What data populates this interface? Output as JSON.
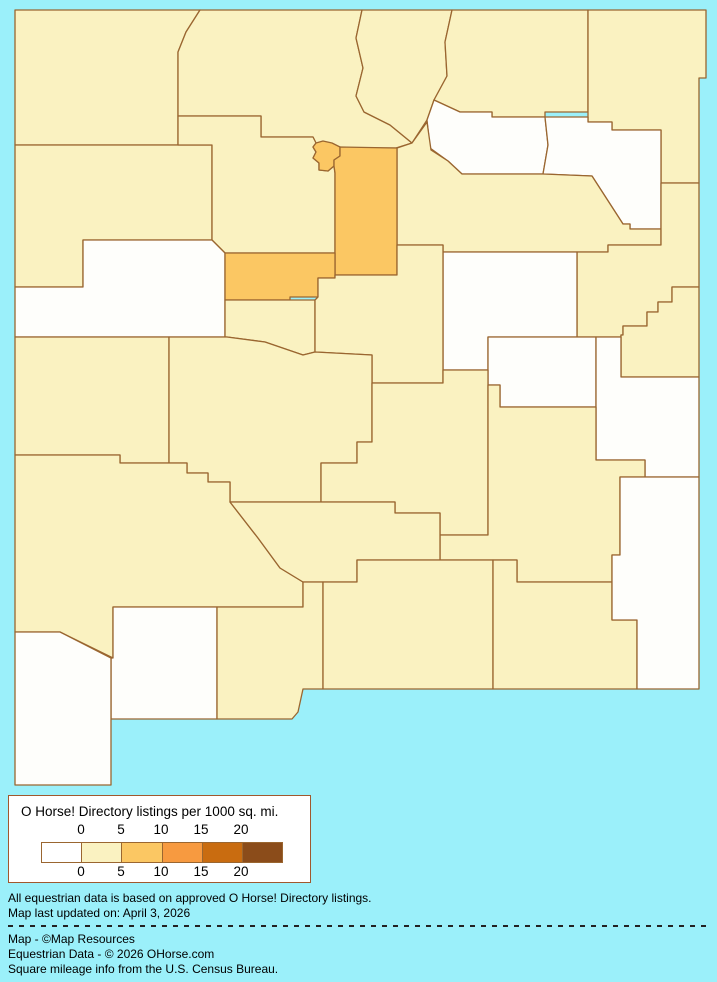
{
  "colors": {
    "background": "#9BF0FA",
    "county_border": "#9A6630",
    "bins": {
      "zero": "#FEFEFB",
      "low": "#FAF2C1",
      "mid": "#FBC763"
    }
  },
  "legend": {
    "title": "O Horse! Directory listings per 1000 sq. mi.",
    "ticks": [
      "0",
      "5",
      "10",
      "15",
      "20"
    ],
    "swatches": [
      "#FFFFFF",
      "#FAF2C1",
      "#FBC763",
      "#F79A40",
      "#C96C10",
      "#8B4C1A"
    ],
    "scale_note": "bins: 0, 0-5, 5-10, 10-15, 15-20, 20+"
  },
  "footer": {
    "line1": "All equestrian data is based on approved O Horse! Directory listings.",
    "line2": "Map last updated on: April 3, 2026",
    "line3": "Map - ©Map Resources",
    "line4": "Equestrian Data - © 2026 OHorse.com",
    "line5": "Square mileage info from the U.S. Census Bureau."
  },
  "map": {
    "region": "New Mexico counties choropleth",
    "counties": [
      {
        "id": "san-juan",
        "bin": "low",
        "d": "M15,10 L200,10 L186,32 L178,52 L178,145 L15,145 Z"
      },
      {
        "id": "rio-arriba",
        "bin": "low",
        "d": "M200,10 L362,10 L356,38 L363,68 L356,96 L364,112 L390,125 L412,143 L396,148 L342,148 L340,147 L316,143 L313,137 L261,137 L261,116 L178,116 L178,52 L186,32 Z"
      },
      {
        "id": "taos",
        "bin": "low",
        "d": "M362,10 L452,10 L445,42 L447,76 L434,100 L427,120 L412,143 L390,125 L364,112 L356,96 L363,68 L356,38 Z"
      },
      {
        "id": "colfax",
        "bin": "low",
        "d": "M452,10 L588,10 L588,112 L545,112 L545,117 L492,117 L492,112 L460,112 L434,100 L447,76 L445,42 Z"
      },
      {
        "id": "union",
        "bin": "low",
        "d": "M588,10 L706,10 L706,78 L699,78 L699,183 L661,183 L661,130 L612,130 L612,122 L588,122 Z"
      },
      {
        "id": "mora",
        "bin": "zero",
        "d": "M434,100 L460,112 L492,112 L492,117 L545,117 L548,145 L543,174 L462,174 L448,161 L430,148 L427,120 Z"
      },
      {
        "id": "harding",
        "bin": "zero",
        "d": "M545,117 L588,117 L588,122 L612,122 L612,130 L661,130 L661,229 L630,229 L630,224 L623,224 L592,176 L543,174 L548,145 Z"
      },
      {
        "id": "san-miguel",
        "bin": "low",
        "d": "M397,148 L412,143 L427,122 L431,150 L448,161 L462,174 L543,174 L592,176 L623,224 L630,224 L630,229 L661,229 L661,245 L608,245 L608,252 L443,252 L443,245 L397,245 Z"
      },
      {
        "id": "quay",
        "bin": "low",
        "d": "M661,183 L699,183 L699,287 L672,287 L672,302 L658,302 L658,312 L647,312 L647,326 L623,326 L623,335 L621,335 L621,337 L577,337 L577,252 L608,252 L608,245 L661,245 Z"
      },
      {
        "id": "curry",
        "bin": "low",
        "d": "M672,287 L699,287 L699,377 L621,377 L621,335 L623,335 L623,326 L647,326 L647,312 L658,312 L658,302 L672,302 Z"
      },
      {
        "id": "guadalupe",
        "bin": "zero",
        "d": "M443,252 L577,252 L577,337 L488,337 L488,370 L443,370 Z"
      },
      {
        "id": "de-baca",
        "bin": "zero",
        "d": "M488,337 L596,337 L596,407 L500,407 L500,385 L488,385 Z"
      },
      {
        "id": "roosevelt",
        "bin": "zero",
        "d": "M596,337 L621,337 L621,377 L699,377 L699,477 L645,477 L645,460 L596,460 Z"
      },
      {
        "id": "mckinley",
        "bin": "low",
        "d": "M15,145 L212,145 L212,240 L83,240 L83,287 L15,287 Z"
      },
      {
        "id": "sandoval",
        "bin": "low",
        "d": "M178,116 L261,116 L261,137 L313,137 L316,143 L313,147 L316,152 L313,158 L319,163 L319,170 L328,171 L334,166 L335,173 L335,253 L225,253 L212,240 L212,145 L178,145 Z"
      },
      {
        "id": "cibola",
        "bin": "zero",
        "d": "M83,240 L212,240 L225,253 L225,337 L15,337 L15,287 L83,287 Z"
      },
      {
        "id": "los-alamos",
        "bin": "mid",
        "d": "M313,147 L316,143 L323,141 L332,143 L340,147 L340,156 L334,160 L334,166 L328,171 L319,170 L319,163 L313,158 L316,152 Z"
      },
      {
        "id": "santa-fe",
        "bin": "mid",
        "d": "M340,147 L397,148 L397,275 L335,275 L335,173 L334,166 L334,160 L340,156 Z"
      },
      {
        "id": "bernalillo",
        "bin": "mid",
        "d": "M225,253 L335,253 L335,278 L318,278 L318,297 L290,297 L290,300 L225,300 Z"
      },
      {
        "id": "valencia",
        "bin": "low",
        "d": "M225,300 L315,300 L315,352 L303,355 L265,342 L227,337 L225,337 Z"
      },
      {
        "id": "torrance",
        "bin": "low",
        "d": "M315,352 L315,300 L318,297 L318,278 L335,278 L335,275 L397,275 L397,245 L443,245 L443,383 L372,383 L372,355 Z"
      },
      {
        "id": "catron",
        "bin": "low",
        "d": "M15,337 L169,337 L169,463 L120,463 L120,455 L15,455 Z"
      },
      {
        "id": "socorro",
        "bin": "low",
        "d": "M169,337 L227,337 L265,342 L303,355 L315,352 L372,355 L372,442 L357,442 L357,463 L321,463 L321,502 L230,502 L230,482 L208,482 L208,473 L187,473 L187,463 L169,463 Z"
      },
      {
        "id": "lincoln",
        "bin": "low",
        "d": "M372,383 L443,383 L443,370 L488,370 L488,535 L440,535 L440,513 L395,513 L395,502 L321,502 L321,463 L357,463 L357,442 L372,442 Z"
      },
      {
        "id": "chaves",
        "bin": "low",
        "d": "M488,385 L500,385 L500,407 L596,407 L596,460 L645,460 L645,477 L620,477 L620,555 L612,555 L612,582 L517,582 L517,560 L440,560 L440,535 L488,535 Z"
      },
      {
        "id": "grant",
        "bin": "low",
        "d": "M15,455 L120,455 L120,463 L187,463 L187,473 L208,473 L208,482 L230,482 L230,502 L258,538 L280,568 L303,582 L303,607 L113,607 L113,658 L60,632 L15,632 Z"
      },
      {
        "id": "sierra",
        "bin": "low",
        "d": "M230,502 L321,502 L395,502 L395,513 L440,513 L440,560 L357,560 L357,582 L303,582 L280,568 L258,538 Z"
      },
      {
        "id": "luna",
        "bin": "zero",
        "d": "M113,607 L217,607 L217,719 L111,719 L111,658 L113,658 Z"
      },
      {
        "id": "hidalgo",
        "bin": "zero",
        "d": "M15,632 L60,632 L111,658 L111,785 L15,785 Z"
      },
      {
        "id": "dona-ana",
        "bin": "low",
        "d": "M217,607 L303,607 L303,582 L323,582 L323,689 L303,689 L298,712 L292,719 L217,719 Z"
      },
      {
        "id": "otero",
        "bin": "low",
        "d": "M323,582 L357,582 L357,560 L493,560 L493,689 L323,689 Z"
      },
      {
        "id": "eddy",
        "bin": "low",
        "d": "M493,560 L517,560 L517,582 L612,582 L612,620 L637,620 L637,689 L493,689 Z"
      },
      {
        "id": "lea",
        "bin": "zero",
        "d": "M620,477 L699,477 L699,689 L637,689 L637,620 L612,620 L612,555 L620,555 Z"
      }
    ]
  }
}
